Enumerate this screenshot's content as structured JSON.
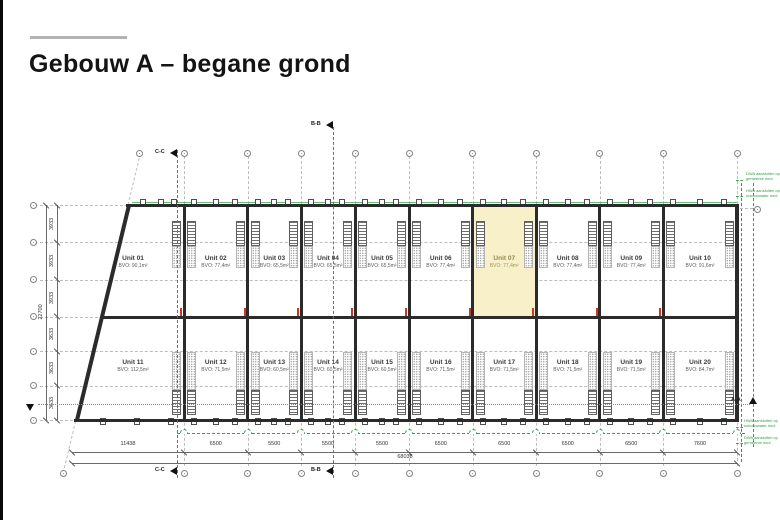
{
  "page": {
    "title": "Gebouw A – begane grond"
  },
  "plan": {
    "units": [
      {
        "name": "Unit 01",
        "bvo": "BVO: 90,1m²",
        "row": 0,
        "col": 0,
        "highlighted": false
      },
      {
        "name": "Unit 02",
        "bvo": "BVO: 77,4m²",
        "row": 0,
        "col": 1,
        "highlighted": false
      },
      {
        "name": "Unit 03",
        "bvo": "BVO: 65,5m²",
        "row": 0,
        "col": 2,
        "highlighted": false
      },
      {
        "name": "Unit 04",
        "bvo": "BVO: 65,5m²",
        "row": 0,
        "col": 3,
        "highlighted": false
      },
      {
        "name": "Unit 05",
        "bvo": "BVO: 65,5m²",
        "row": 0,
        "col": 4,
        "highlighted": false
      },
      {
        "name": "Unit 06",
        "bvo": "BVO: 77,4m²",
        "row": 0,
        "col": 5,
        "highlighted": false
      },
      {
        "name": "Unit 07",
        "bvo": "BVO: 77,4m²",
        "row": 0,
        "col": 6,
        "highlighted": true
      },
      {
        "name": "Unit 08",
        "bvo": "BVO: 77,4m²",
        "row": 0,
        "col": 7,
        "highlighted": false
      },
      {
        "name": "Unit 09",
        "bvo": "BVO: 77,4m²",
        "row": 0,
        "col": 8,
        "highlighted": false
      },
      {
        "name": "Unit 10",
        "bvo": "BVO: 91,6m²",
        "row": 0,
        "col": 9,
        "highlighted": false
      },
      {
        "name": "Unit 11",
        "bvo": "BVO: 112,5m²",
        "row": 1,
        "col": 0,
        "highlighted": false
      },
      {
        "name": "Unit 12",
        "bvo": "BVO: 71,5m²",
        "row": 1,
        "col": 1,
        "highlighted": false
      },
      {
        "name": "Unit 13",
        "bvo": "BVO: 60,5m²",
        "row": 1,
        "col": 2,
        "highlighted": false
      },
      {
        "name": "Unit 14",
        "bvo": "BVO: 60,5m²",
        "row": 1,
        "col": 3,
        "highlighted": false
      },
      {
        "name": "Unit 15",
        "bvo": "BVO: 60,5m²",
        "row": 1,
        "col": 4,
        "highlighted": false
      },
      {
        "name": "Unit 16",
        "bvo": "BVO: 71,5m²",
        "row": 1,
        "col": 5,
        "highlighted": false
      },
      {
        "name": "Unit 17",
        "bvo": "BVO: 71,5m²",
        "row": 1,
        "col": 6,
        "highlighted": false
      },
      {
        "name": "Unit 18",
        "bvo": "BVO: 71,5m²",
        "row": 1,
        "col": 7,
        "highlighted": false
      },
      {
        "name": "Unit 19",
        "bvo": "BVO: 71,5m²",
        "row": 1,
        "col": 8,
        "highlighted": false
      },
      {
        "name": "Unit 20",
        "bvo": "BVO: 84,7m²",
        "row": 1,
        "col": 9,
        "highlighted": false
      }
    ],
    "dimensions": {
      "columns": [
        "11438",
        "6500",
        "5500",
        "5500",
        "5500",
        "6500",
        "6500",
        "6500",
        "6500",
        "7600"
      ],
      "total_width": "68038",
      "rows": [
        "3933",
        "3933",
        "3933",
        "3633",
        "3633",
        "3633"
      ],
      "total_height": "22700"
    },
    "sections": {
      "bb": "B-B",
      "cc": "C-C",
      "aa": "A-A"
    },
    "annotations": {
      "top_right": [
        "DWA aansluiten op\ngemeente riool",
        "HWA aansluiten op\nschoonwater riool"
      ],
      "bottom_right": [
        "HWA aansluiten op\nschoonwater riool",
        "DWA aansluiten op\ngemeente riool"
      ]
    },
    "colors": {
      "highlight": "#f8f0c8",
      "wall": "#2b2b2b",
      "grid": "#bdbdbd",
      "green": "#3a9e4c",
      "red": "#c0392b"
    }
  }
}
